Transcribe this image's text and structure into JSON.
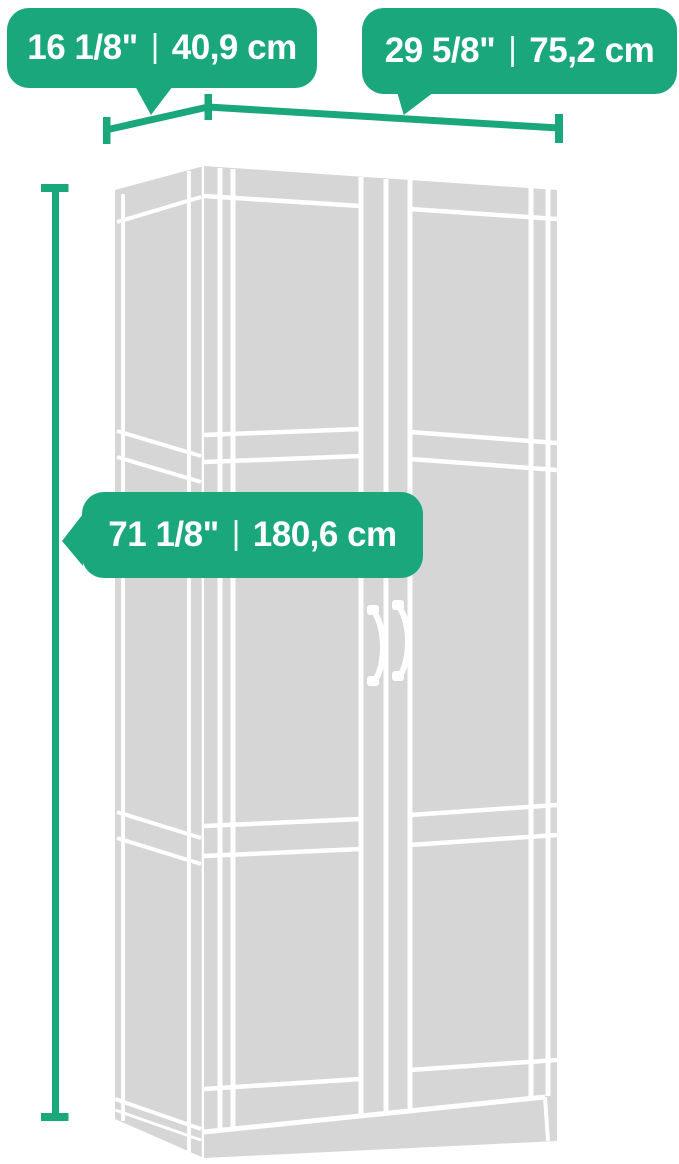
{
  "colors": {
    "accent_green": "#1ba77c",
    "cabinet_gray": "#d6d6d6",
    "outline_white": "#ffffff",
    "label_text": "#ffffff",
    "background": "#ffffff"
  },
  "dimension_labels": {
    "separator": "|",
    "depth": {
      "inches": "16 1/8\"",
      "centimeters": "40,9 cm"
    },
    "width": {
      "inches": "29 5/8\"",
      "centimeters": "75,2 cm"
    },
    "height": {
      "inches": "71 1/8\"",
      "centimeters": "180,6 cm"
    }
  }
}
